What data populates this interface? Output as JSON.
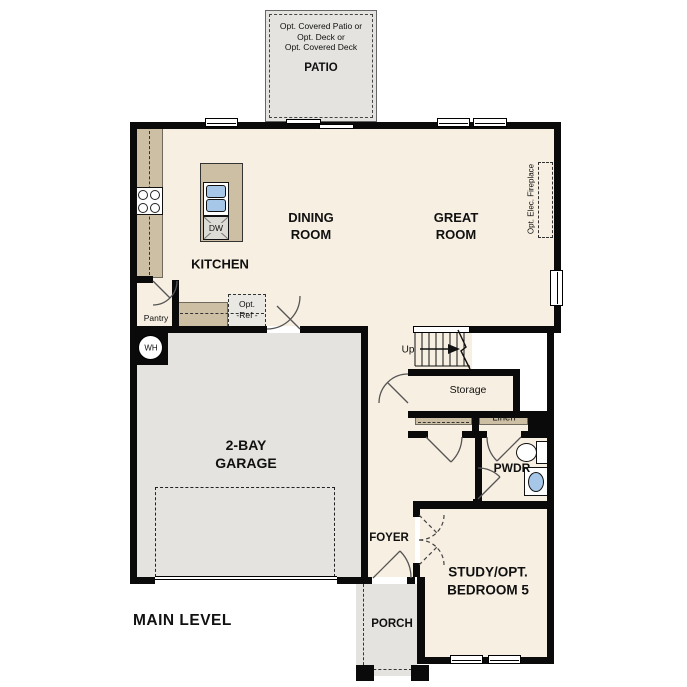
{
  "plan": {
    "level_label": "MAIN LEVEL",
    "rooms": {
      "dining": "DINING\nROOM",
      "great": "GREAT\nROOM",
      "kitchen": "KITCHEN",
      "garage": "2-BAY\nGARAGE",
      "study": "STUDY/OPT.\nBEDROOM 5",
      "foyer": "FOYER",
      "porch": "PORCH",
      "powder": "PWDR",
      "patio": "PATIO"
    },
    "annotations": {
      "patio_options": "Opt. Covered Patio or\nOpt. Deck or\nOpt. Covered Deck",
      "pantry": "Pantry",
      "storage": "Storage",
      "linen": "Linen",
      "stairs_up": "Up",
      "water_heater": "WH",
      "dishwasher": "DW",
      "opt_ref": "Opt.\n-Ref -",
      "opt_fireplace": "Opt. Elec. Fireplace"
    },
    "colors": {
      "wall": "#0a0a0a",
      "floor": "#f7efe2",
      "cabinet_tan": "#cdbfa3",
      "concrete_gray": "#e4e3df",
      "fixture_blue": "#a7c7e8"
    }
  }
}
